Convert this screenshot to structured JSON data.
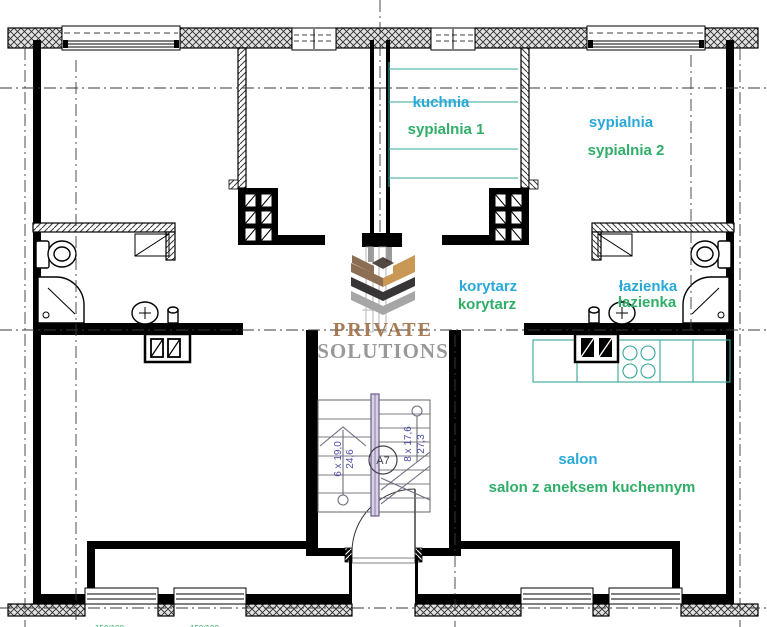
{
  "colors": {
    "label_primary": "#29a9d9",
    "label_secondary": "#2fae68",
    "counter_teal": "#35a79b",
    "stair_dim_text": "#4d4da8",
    "logo_gold": "#c18a3d",
    "logo_brown": "#7d5b3e",
    "logo_black": "#1c1a1a",
    "logo_gray": "#9a9a9a",
    "logo_text_primary": "#9b6a3f",
    "logo_text_secondary": "#8c8c8c"
  },
  "rooms": {
    "kitchen_primary": "kuchnia",
    "kitchen_secondary": "sypialnia 1",
    "bedroom_primary": "sypialnia",
    "bedroom_secondary": "sypialnia 2",
    "corridor_primary": "korytarz",
    "corridor_secondary": "korytarz",
    "bathroom_primary": "łazienka",
    "bathroom_secondary": "łazienka",
    "living_primary": "salon",
    "living_secondary": "salon z aneksem kuchennym"
  },
  "stairs": {
    "left_flight_steps": "6 x 19,0",
    "left_flight_width": "24,6",
    "right_flight_steps": "8 x 17,6",
    "right_flight_width": "27,3",
    "marker": "A7"
  },
  "watermark": {
    "line1": "PRIVATE",
    "line2": "SOLUTIONS"
  },
  "window_annotations": {
    "left": "150/100",
    "mid": "150/100"
  }
}
